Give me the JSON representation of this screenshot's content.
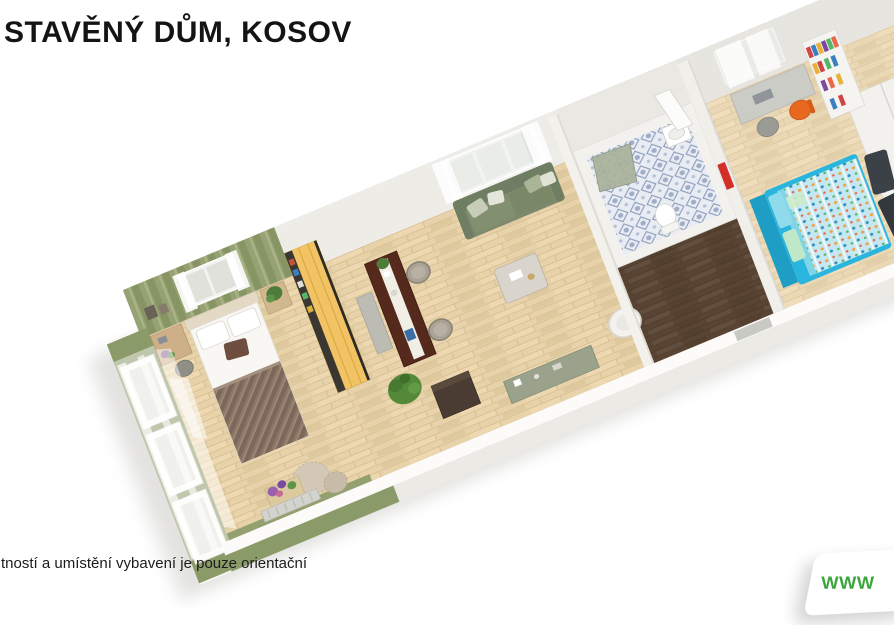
{
  "page": {
    "width": 894,
    "height": 625,
    "background": "#ffffff"
  },
  "header": {
    "title": "STAVĚNÝ DŮM, KOSOV"
  },
  "footer": {
    "disclaimer": "tností a umístění vybavení je pouze orientační"
  },
  "watermark_badge": {
    "text": "WWW",
    "text_color": "#3aa63d",
    "background": "#ffffff"
  },
  "floorplan": {
    "type": "3d-floorplan-render",
    "rooms": [
      "bedroom",
      "living-dining-room",
      "bathroom",
      "hallway",
      "kids-bedroom"
    ],
    "colors": {
      "wood": "#e7d2a9",
      "wall_green": "#97a274",
      "wall_green_dark": "#879565",
      "ext_green": "#8a9a68",
      "wardrobe": "#f1c364",
      "sofa": "#7d8a6e",
      "hall": "#594434",
      "bed_blue": "#29b5dd",
      "chair_orange": "#e8681f",
      "badge_green": "#3aa63d"
    }
  }
}
